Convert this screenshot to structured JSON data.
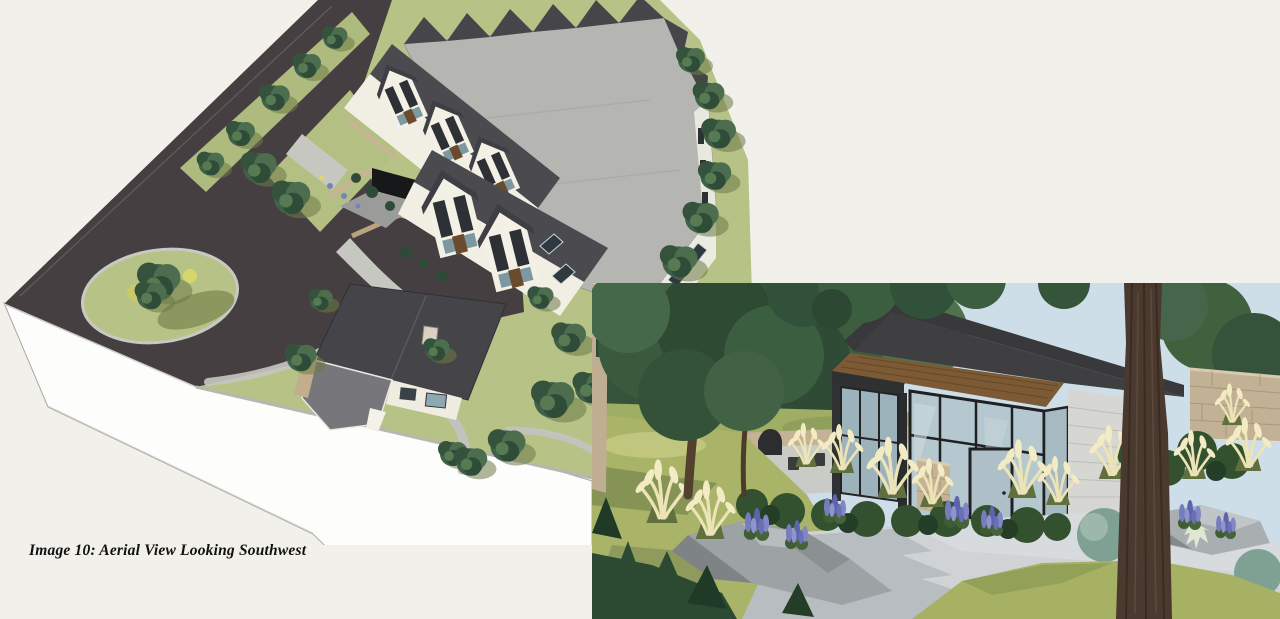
{
  "page": {
    "background_color": "#f1f0ea",
    "caption": "Image 10: Aerial View Looking Southwest"
  },
  "figures": {
    "aerial_rendering": {
      "label": "aerial-site-rendering",
      "colors": {
        "asphalt": "#453f41",
        "grass": "#b7c287",
        "roof_plane": "#b5b5b1",
        "roof_dark": "#4a4a4f",
        "walls": "#f2efe4",
        "stone": "#c8b493",
        "path": "#c7c7c1",
        "site_base": "#fdfdfc"
      }
    },
    "clubhouse_rendering": {
      "label": "clubhouse-entry-rendering",
      "colors": {
        "sky": "#cddee9",
        "foliage": "#3d5c40",
        "lawn": "#aab468",
        "paving": "#cfd3d6",
        "paving_shadow": "#b7bdc1",
        "roof": "#39393b",
        "soffit_wood": "#7c5a35",
        "glass": "#b6c8cf",
        "siding": "#d6d7d2",
        "stone": "#c2b194",
        "pampas_plume": "#ece4b6",
        "lupine": "#7a7fc2",
        "tree_trunk": "#4a392e"
      }
    }
  }
}
